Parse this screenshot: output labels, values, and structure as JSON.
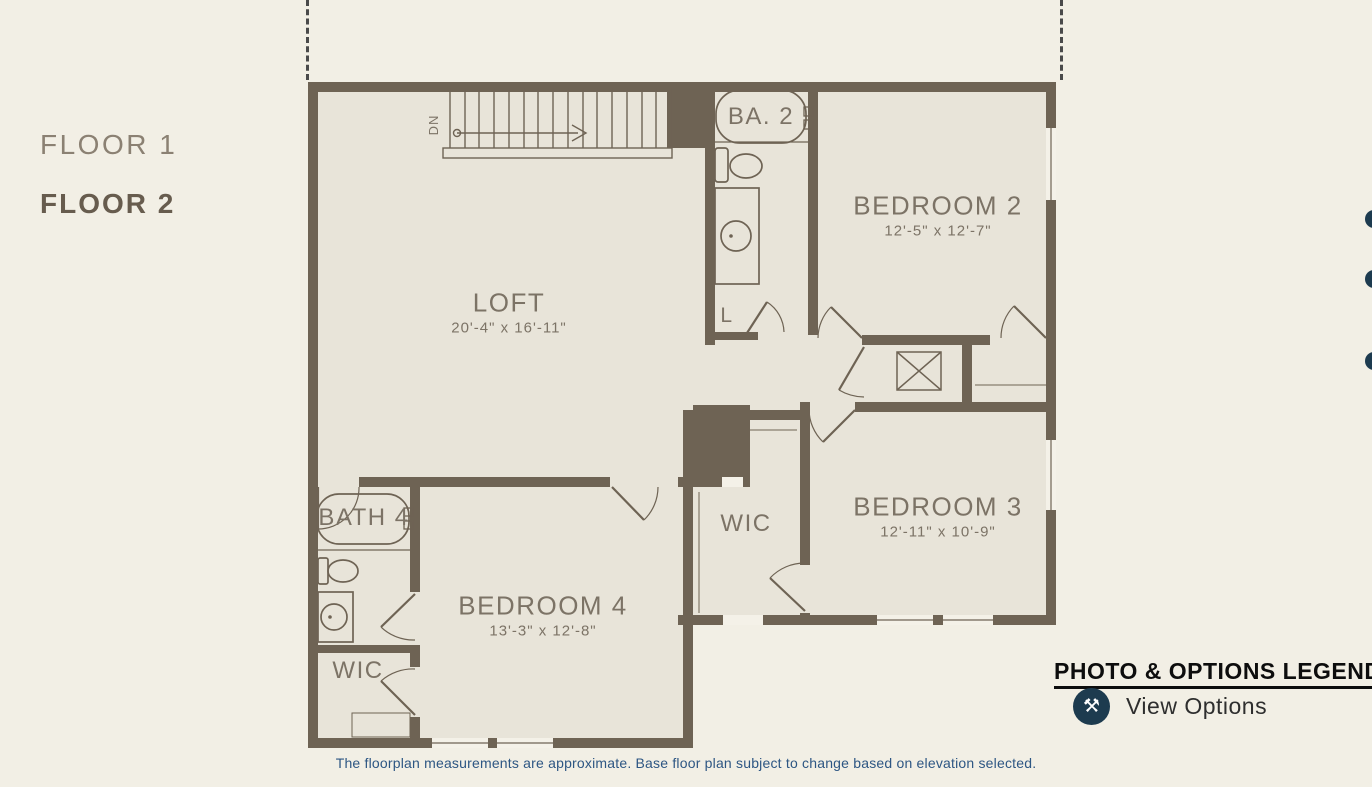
{
  "sidebar": {
    "items": [
      {
        "label": "FLOOR 1",
        "active": false
      },
      {
        "label": "FLOOR 2",
        "active": true
      }
    ]
  },
  "plan": {
    "rooms": {
      "loft": {
        "name": "LOFT",
        "dims": "20'-4\" x 16'-11\""
      },
      "bedroom2": {
        "name": "BEDROOM 2",
        "dims": "12'-5\" x 12'-7\""
      },
      "bedroom3": {
        "name": "BEDROOM 3",
        "dims": "12'-11\" x 10'-9\""
      },
      "bedroom4": {
        "name": "BEDROOM 4",
        "dims": "13'-3\" x 12'-8\""
      },
      "bath2": {
        "name": "BA. 2"
      },
      "bath4": {
        "name": "BATH 4"
      },
      "wic_center": {
        "name": "WIC"
      },
      "wic_lower": {
        "name": "WIC"
      },
      "linen": {
        "name": "L"
      },
      "stair_direction": "DN"
    }
  },
  "legend": {
    "title": "PHOTO & OPTIONS LEGEND",
    "items": [
      {
        "icon": "tools-icon",
        "label": "View Options"
      }
    ]
  },
  "footer": {
    "disclaimer": "The floorplan measurements are approximate. Base floor plan subject to change based on elevation selected."
  },
  "colors": {
    "page_background": "#f2efe5",
    "plan_floor_fill": "#e8e4d9",
    "wall": "#6e6354",
    "label_text": "#7c7366",
    "legend_icon_background": "#1d3b4f",
    "disclaimer_text": "#2d5683",
    "legend_title_text": "#0d0d0d"
  }
}
